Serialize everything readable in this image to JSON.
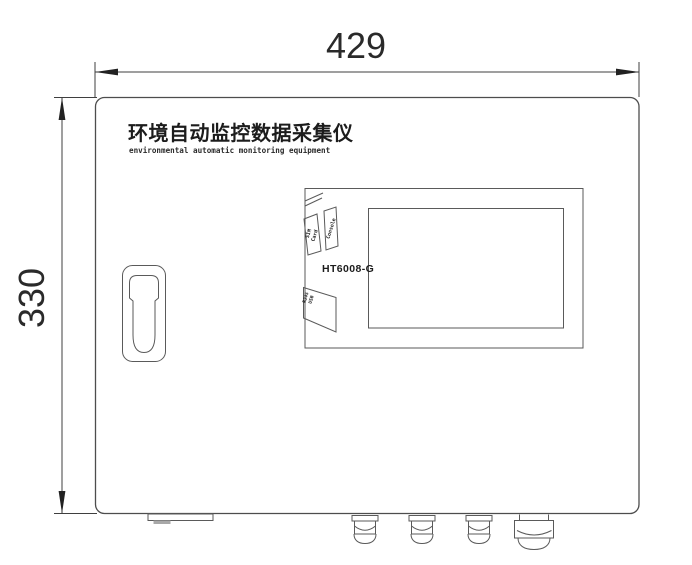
{
  "drawing": {
    "type": "technical-dimension-drawing",
    "device_title": "环境自动监控数据采集仪",
    "device_subtitle": "environmental automatic monitoring equipment",
    "model": "HT6008-G",
    "dimensions": {
      "width_label": "429",
      "height_label": "330"
    },
    "ports": {
      "console_label": "Console",
      "sim_line1": "SIM",
      "sim_line2": "Card",
      "rj45_line1": "RJ45",
      "rj45_line2": "USB"
    },
    "colors": {
      "background": "#ffffff",
      "line": "#4d4d4d",
      "text": "#1c1c1c"
    },
    "notes": {
      "cable_glands_count": "4",
      "units": ""
    }
  }
}
